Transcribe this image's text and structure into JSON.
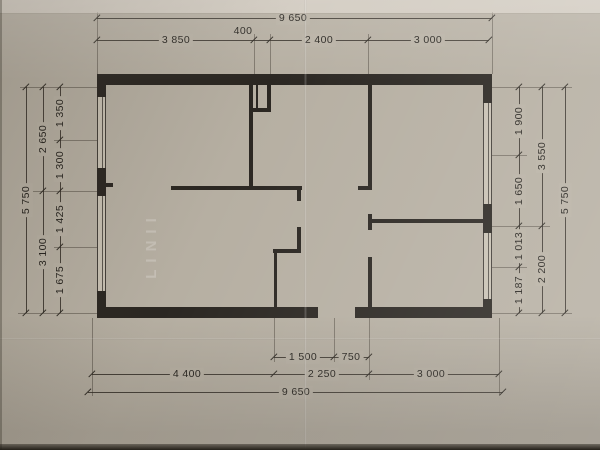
{
  "watermark": {
    "text": "LINII"
  },
  "canvas": {
    "paper": "#b6afa2",
    "ink": "#2e2a24",
    "wall_fill": "#2b2722"
  },
  "dimension_values_mm": {
    "overall_width": "9 650",
    "overall_height": "5 750",
    "top_chain": [
      "3 850",
      "400",
      "2 400",
      "3 000"
    ],
    "bottom_chain": [
      "4 400",
      "2 250",
      "3 000"
    ],
    "bottom_sub_chain": [
      "1 500",
      "750"
    ],
    "left_chain": [
      "1 350",
      "1 300",
      "1 425",
      "1 675"
    ],
    "left_mid_chain": [
      "2 650",
      "3 100"
    ],
    "right_chain": [
      "1 900",
      "1 650",
      "1 013",
      "1 187"
    ],
    "right_mid_chain": [
      "3 550",
      "2 200"
    ]
  },
  "plan": {
    "walls": [
      [
        97,
        74,
        395,
        11
      ],
      [
        97,
        307,
        221,
        11
      ],
      [
        355,
        307,
        137,
        11
      ],
      [
        97,
        74,
        9,
        23
      ],
      [
        97,
        168,
        9,
        28
      ],
      [
        97,
        291,
        9,
        27
      ],
      [
        483,
        74,
        9,
        29
      ],
      [
        483,
        204,
        9,
        29
      ],
      [
        483,
        299,
        9,
        19
      ],
      [
        106,
        183,
        7,
        4
      ],
      [
        249,
        85,
        4,
        105
      ],
      [
        267,
        85,
        4,
        27
      ],
      [
        253,
        108,
        18,
        4
      ],
      [
        256,
        85,
        2,
        23
      ],
      [
        171,
        186,
        131,
        4
      ],
      [
        297,
        190,
        4,
        11
      ],
      [
        297,
        227,
        4,
        26
      ],
      [
        273,
        249,
        28,
        4
      ],
      [
        274,
        253,
        3,
        56
      ],
      [
        358,
        186,
        14,
        4
      ],
      [
        368,
        85,
        4,
        101
      ],
      [
        368,
        214,
        4,
        16
      ],
      [
        368,
        219,
        122,
        4
      ],
      [
        368,
        257,
        4,
        52
      ]
    ],
    "windows": [
      [
        97,
        97,
        9,
        71
      ],
      [
        97,
        196,
        9,
        95
      ],
      [
        483,
        103,
        9,
        101
      ],
      [
        483,
        233,
        9,
        66
      ]
    ]
  },
  "dims": {
    "h_lines": [
      {
        "y": 18,
        "x1": 97,
        "x2": 492,
        "ticks": [
          97,
          492
        ],
        "labels": [
          {
            "t": "9 650",
            "x": 293
          }
        ]
      },
      {
        "y": 40,
        "x1": 97,
        "x2": 489,
        "ticks": [
          97,
          254,
          270,
          368,
          489
        ],
        "labels": [
          {
            "t": "3 850",
            "x": 176
          },
          {
            "t": "400",
            "x": 243,
            "above": 1
          },
          {
            "t": "2 400",
            "x": 319
          },
          {
            "t": "3 000",
            "x": 428
          }
        ]
      },
      {
        "y": 357,
        "x1": 274,
        "x2": 369,
        "ticks": [
          274,
          334,
          369
        ],
        "labels": [
          {
            "t": "1 500",
            "x": 303
          },
          {
            "t": "750",
            "x": 351
          }
        ]
      },
      {
        "y": 374,
        "x1": 92,
        "x2": 499,
        "ticks": [
          92,
          274,
          369,
          499
        ],
        "labels": [
          {
            "t": "4 400",
            "x": 187
          },
          {
            "t": "2 250",
            "x": 322
          },
          {
            "t": "3 000",
            "x": 431
          }
        ]
      },
      {
        "y": 392,
        "x1": 88,
        "x2": 503,
        "ticks": [
          88,
          503
        ],
        "labels": [
          {
            "t": "9 650",
            "x": 296
          }
        ]
      }
    ],
    "v_lines": [
      {
        "x": 60,
        "y1": 87,
        "y2": 313,
        "ticks": [
          87,
          140,
          191,
          247,
          313
        ],
        "labels": [
          {
            "t": "1 350",
            "y": 113
          },
          {
            "t": "1 300",
            "y": 165
          },
          {
            "t": "1 425",
            "y": 219
          },
          {
            "t": "1 675",
            "y": 280
          }
        ]
      },
      {
        "x": 43,
        "y1": 87,
        "y2": 313,
        "ticks": [
          87,
          191,
          313
        ],
        "labels": [
          {
            "t": "2 650",
            "y": 139
          },
          {
            "t": "3 100",
            "y": 252
          }
        ]
      },
      {
        "x": 26,
        "y1": 87,
        "y2": 313,
        "ticks": [
          87,
          313
        ],
        "labels": [
          {
            "t": "5 750",
            "y": 200
          }
        ]
      },
      {
        "x": 519,
        "y1": 87,
        "y2": 313,
        "ticks": [
          87,
          155,
          226,
          267,
          313
        ],
        "labels": [
          {
            "t": "1 900",
            "y": 121
          },
          {
            "t": "1 650",
            "y": 191
          },
          {
            "t": "1 013",
            "y": 246
          },
          {
            "t": "1 187",
            "y": 290
          }
        ]
      },
      {
        "x": 542,
        "y1": 87,
        "y2": 313,
        "ticks": [
          87,
          226,
          313
        ],
        "labels": [
          {
            "t": "3 550",
            "y": 156
          },
          {
            "t": "2 200",
            "y": 269
          }
        ]
      },
      {
        "x": 565,
        "y1": 87,
        "y2": 313,
        "ticks": [
          87,
          313
        ],
        "labels": [
          {
            "t": "5 750",
            "y": 200
          }
        ]
      }
    ],
    "ext_v": [
      [
        97,
        12,
        74
      ],
      [
        492,
        12,
        74
      ],
      [
        254,
        34,
        74
      ],
      [
        270,
        34,
        74
      ],
      [
        368,
        34,
        74
      ],
      [
        92,
        318,
        396
      ],
      [
        274,
        318,
        362
      ],
      [
        334,
        318,
        362
      ],
      [
        369,
        318,
        380
      ],
      [
        499,
        318,
        396
      ]
    ],
    "ext_h": [
      [
        87,
        20,
        97
      ],
      [
        140,
        54,
        97
      ],
      [
        191,
        33,
        97
      ],
      [
        247,
        54,
        97
      ],
      [
        313,
        18,
        97
      ],
      [
        87,
        492,
        572
      ],
      [
        155,
        492,
        527
      ],
      [
        226,
        492,
        550
      ],
      [
        267,
        492,
        527
      ],
      [
        313,
        492,
        572
      ]
    ]
  }
}
